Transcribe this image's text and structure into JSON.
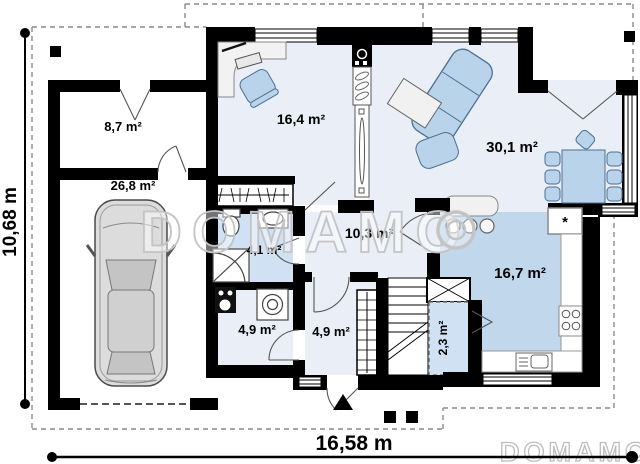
{
  "plan": {
    "rooms": [
      {
        "id": "storage",
        "area": "8,7 m²"
      },
      {
        "id": "garage",
        "area": "26,8 m²"
      },
      {
        "id": "office",
        "area": "16,4 m²"
      },
      {
        "id": "living",
        "area": "30,1 m²"
      },
      {
        "id": "bathroom",
        "area": "4,1 m²"
      },
      {
        "id": "hallway",
        "area": "10,3 m²"
      },
      {
        "id": "kitchen",
        "area": "16,7 m²"
      },
      {
        "id": "utility",
        "area": "4,9 m²"
      },
      {
        "id": "vestibule",
        "area": "4,9 m²"
      },
      {
        "id": "pantry",
        "area": "2,3 m²"
      }
    ],
    "dimensions": {
      "width": "16,58 m",
      "height": "10,68 m"
    },
    "watermark": {
      "center": "DOMAMO",
      "bottom": "DOMAMO"
    },
    "symbols": {
      "fridge": "*"
    },
    "colors": {
      "wall": "#000000",
      "floor_light": "#e9eef7",
      "floor_medium": "#cfe1f2",
      "floor_kitchen": "#c0d7ec",
      "furniture": "#b9d3ea",
      "furniture_stroke": "#4c6f93",
      "watermark": "#c4c4c4",
      "dash": "#8a8a8a"
    }
  }
}
